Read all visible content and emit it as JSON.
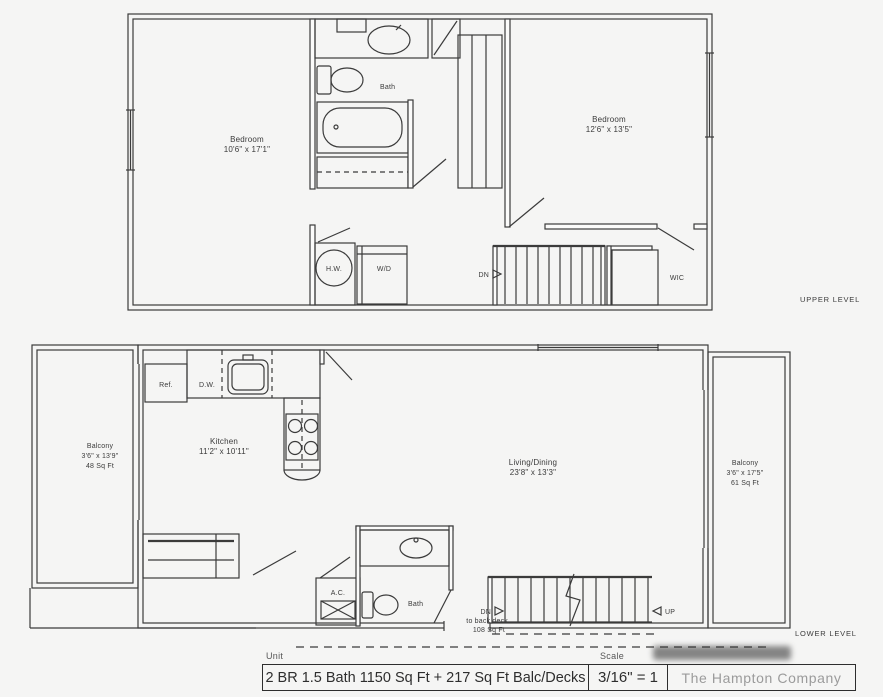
{
  "colors": {
    "line": "#3b3b3b",
    "background": "#f5f5f4"
  },
  "upper": {
    "caption": "UPPER LEVEL",
    "bedroom1_name": "Bedroom",
    "bedroom1_dims": "10'6\" x 17'1\"",
    "bedroom2_name": "Bedroom",
    "bedroom2_dims": "12'6\" x 13'5\"",
    "bath_label": "Bath",
    "hw_label": "H.W.",
    "wd_label": "W/D",
    "dn_label": "DN",
    "wic_label": "WIC"
  },
  "lower": {
    "caption": "LOWER LEVEL",
    "balcony_left_name": "Balcony",
    "balcony_left_dims": "3'6\" x 13'9\"",
    "balcony_left_area": "48 Sq Ft",
    "balcony_right_name": "Balcony",
    "balcony_right_dims": "3'6\" x 17'5\"",
    "balcony_right_area": "61 Sq Ft",
    "ref_label": "Ref.",
    "dw_label": "D.W.",
    "kitchen_name": "Kitchen",
    "kitchen_dims": "11'2\" x 10'11\"",
    "living_name": "Living/Dining",
    "living_dims": "23'8\" x 13'3\"",
    "ac_label": "A.C.",
    "bath_label": "Bath",
    "dn_label": "DN",
    "dn_note1": "to back deck",
    "dn_note2": "108 Sq Ft",
    "up_label": "UP"
  },
  "titlebar": {
    "unit_label": "Unit",
    "unit_value": "2 BR 1.5 Bath  1150 Sq Ft + 217 Sq Ft Balc/Decks",
    "scale_label": "Scale",
    "scale_value": "3/16\" = 1",
    "company": "The Hampton Company"
  }
}
